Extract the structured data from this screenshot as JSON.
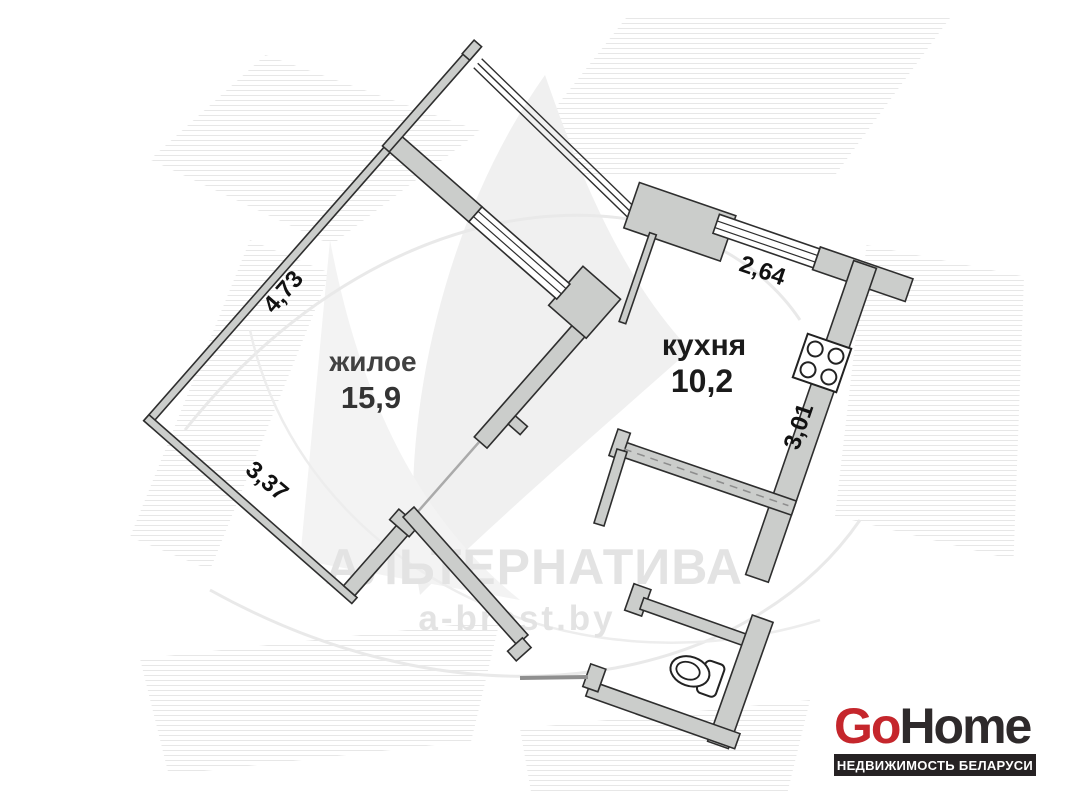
{
  "watermark": {
    "brand": "АЛЬТЕРНАТИВА",
    "site": "a-brest.by",
    "color": "#e3e3e3"
  },
  "plan": {
    "rooms": [
      {
        "id": "living-room",
        "name_label": "жилое",
        "area_label": "15,9"
      },
      {
        "id": "kitchen",
        "name_label": "кухня",
        "area_label": "10,2"
      }
    ],
    "dimensions": [
      {
        "side": "living-room-top-left-wall",
        "label": "4,73"
      },
      {
        "side": "living-room-bottom-left-wall",
        "label": "3,37"
      },
      {
        "side": "kitchen-top-wall",
        "label": "2,64"
      },
      {
        "side": "kitchen-right-wall",
        "label": "3,01"
      }
    ],
    "fixtures": [
      "stove",
      "toilet"
    ],
    "colors": {
      "wall_fill": "#cbcdcb",
      "wall_outline": "#2e2e2e",
      "room_label": "#1b1b1b",
      "dimension_label": "#111111"
    }
  },
  "logo": {
    "go": "Go",
    "home": "Home",
    "tagline": "НЕДВИЖИМОСТЬ БЕЛАРУСИ",
    "go_color": "#c5262c",
    "home_color": "#2e2a2b",
    "tagline_bg": "#262223",
    "tagline_color": "#ffffff"
  }
}
